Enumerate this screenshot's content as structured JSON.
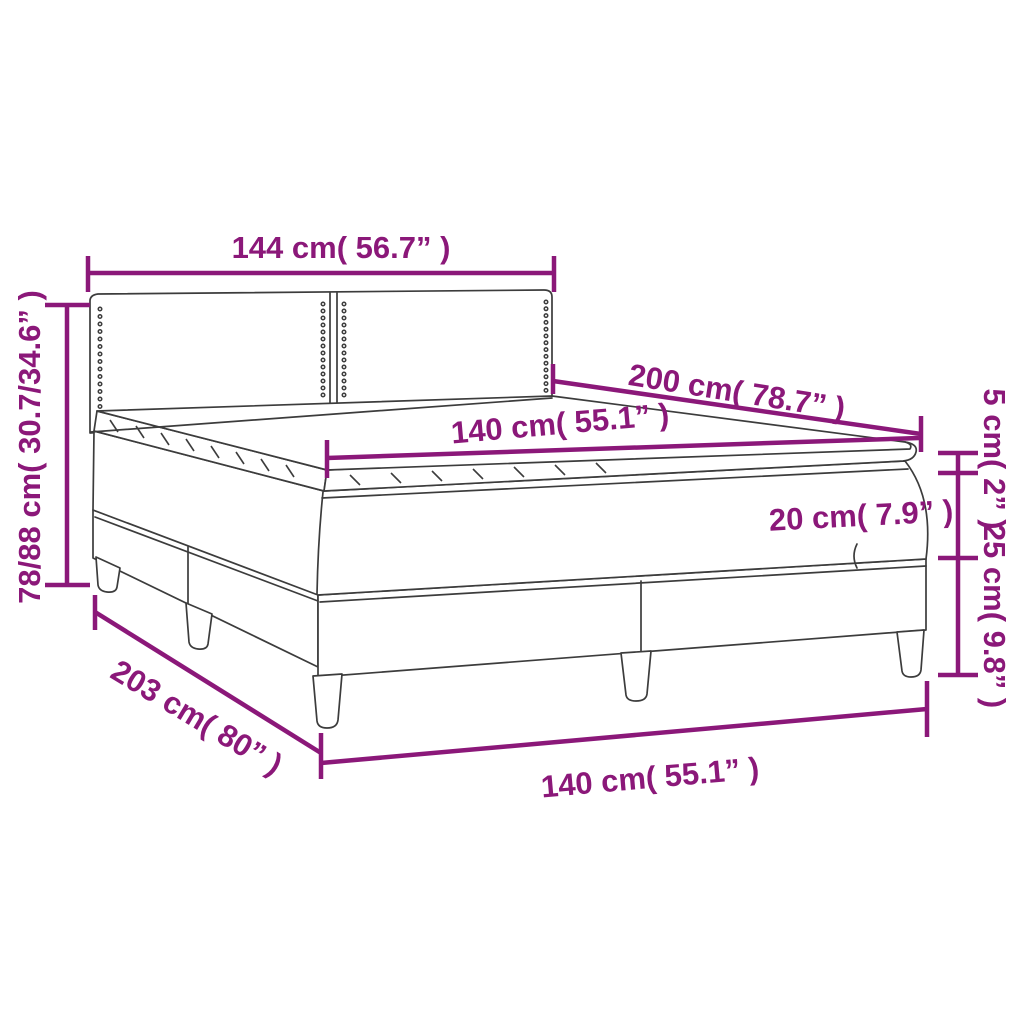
{
  "diagram": {
    "subject": "box-spring-bed-dimension-diagram",
    "background": "#FFFFFF",
    "accent_color": "#8B1879",
    "outline_color": "#3C3C3C",
    "labels": {
      "headboard_width": "144 cm( 56.7” )",
      "bed_length_top": "200 cm( 78.7” )",
      "mattress_width_top": "140 cm( 55.1” )",
      "topper_height": "5 cm( 2” )",
      "mattress_height": "20 cm( 7.9” )",
      "base_height": "25 cm( 9.8” )",
      "total_height": "78/88 cm( 30.7/34.6” )",
      "total_length": "203 cm( 80” )",
      "bed_width_bottom": "140 cm( 55.1” )"
    }
  }
}
